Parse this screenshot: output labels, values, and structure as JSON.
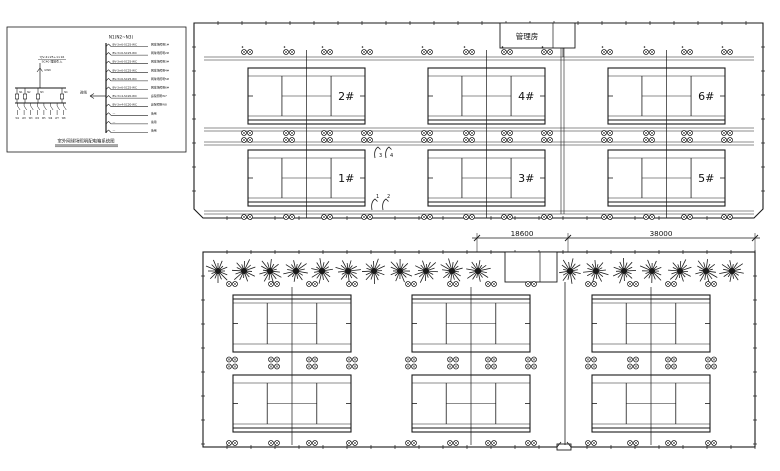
{
  "drawing": {
    "title_hint": "outdoor tennis court lighting layout",
    "line_color": "#1a1a1a",
    "schematic": {
      "panel_title": "N1(N2~N3)",
      "incoming_cable_line1": "YJV-4×25+1×16",
      "incoming_cable_line2": "SC40 埋地引入",
      "meter_label": "kWh",
      "incoming_arrow_label": "进线",
      "branch_labels": [
        "N1",
        "N2",
        "N3",
        "N4"
      ],
      "terminal_labels": [
        "W1",
        "W2",
        "W3",
        "W4",
        "W5",
        "W6",
        "W7",
        "W8"
      ],
      "circuits": [
        {
          "cable": "BV-3×6-SC25-WC",
          "load": "网球场照明1#"
        },
        {
          "cable": "BV-3×6-SC25-WC",
          "load": "网球场照明2#"
        },
        {
          "cable": "BV-3×6-SC25-WC",
          "load": "网球场照明3#"
        },
        {
          "cable": "BV-3×6-SC25-WC",
          "load": "网球场照明4#"
        },
        {
          "cable": "BV-3×6-SC25-WC",
          "load": "网球场照明5#"
        },
        {
          "cable": "BV-3×6-SC25-WC",
          "load": "网球场照明6#"
        },
        {
          "cable": "BV-3×4-SC20-WC",
          "load": "庭院照明W7"
        },
        {
          "cable": "BV-3×4-SC20-WC",
          "load": "庭院照明W8"
        },
        {
          "cable": "—",
          "load": "备用"
        },
        {
          "cable": "—",
          "load": "备用"
        },
        {
          "cable": "—",
          "load": "备用"
        }
      ],
      "bottom_title": "室外网球场照明配电箱系统图"
    },
    "top_plan": {
      "room_label": "管理房",
      "court_labels_upper": [
        "2#",
        "4#",
        "6#"
      ],
      "court_labels_lower": [
        "1#",
        "3#",
        "5#"
      ],
      "callouts_mid": [
        "3",
        "4"
      ],
      "callouts_lower": [
        "1",
        "2"
      ]
    },
    "bottom_plan": {
      "tree_count": 18,
      "court_rows": 2,
      "court_cols": 3
    },
    "dimensions": {
      "left": "18600",
      "right": "38000"
    }
  }
}
